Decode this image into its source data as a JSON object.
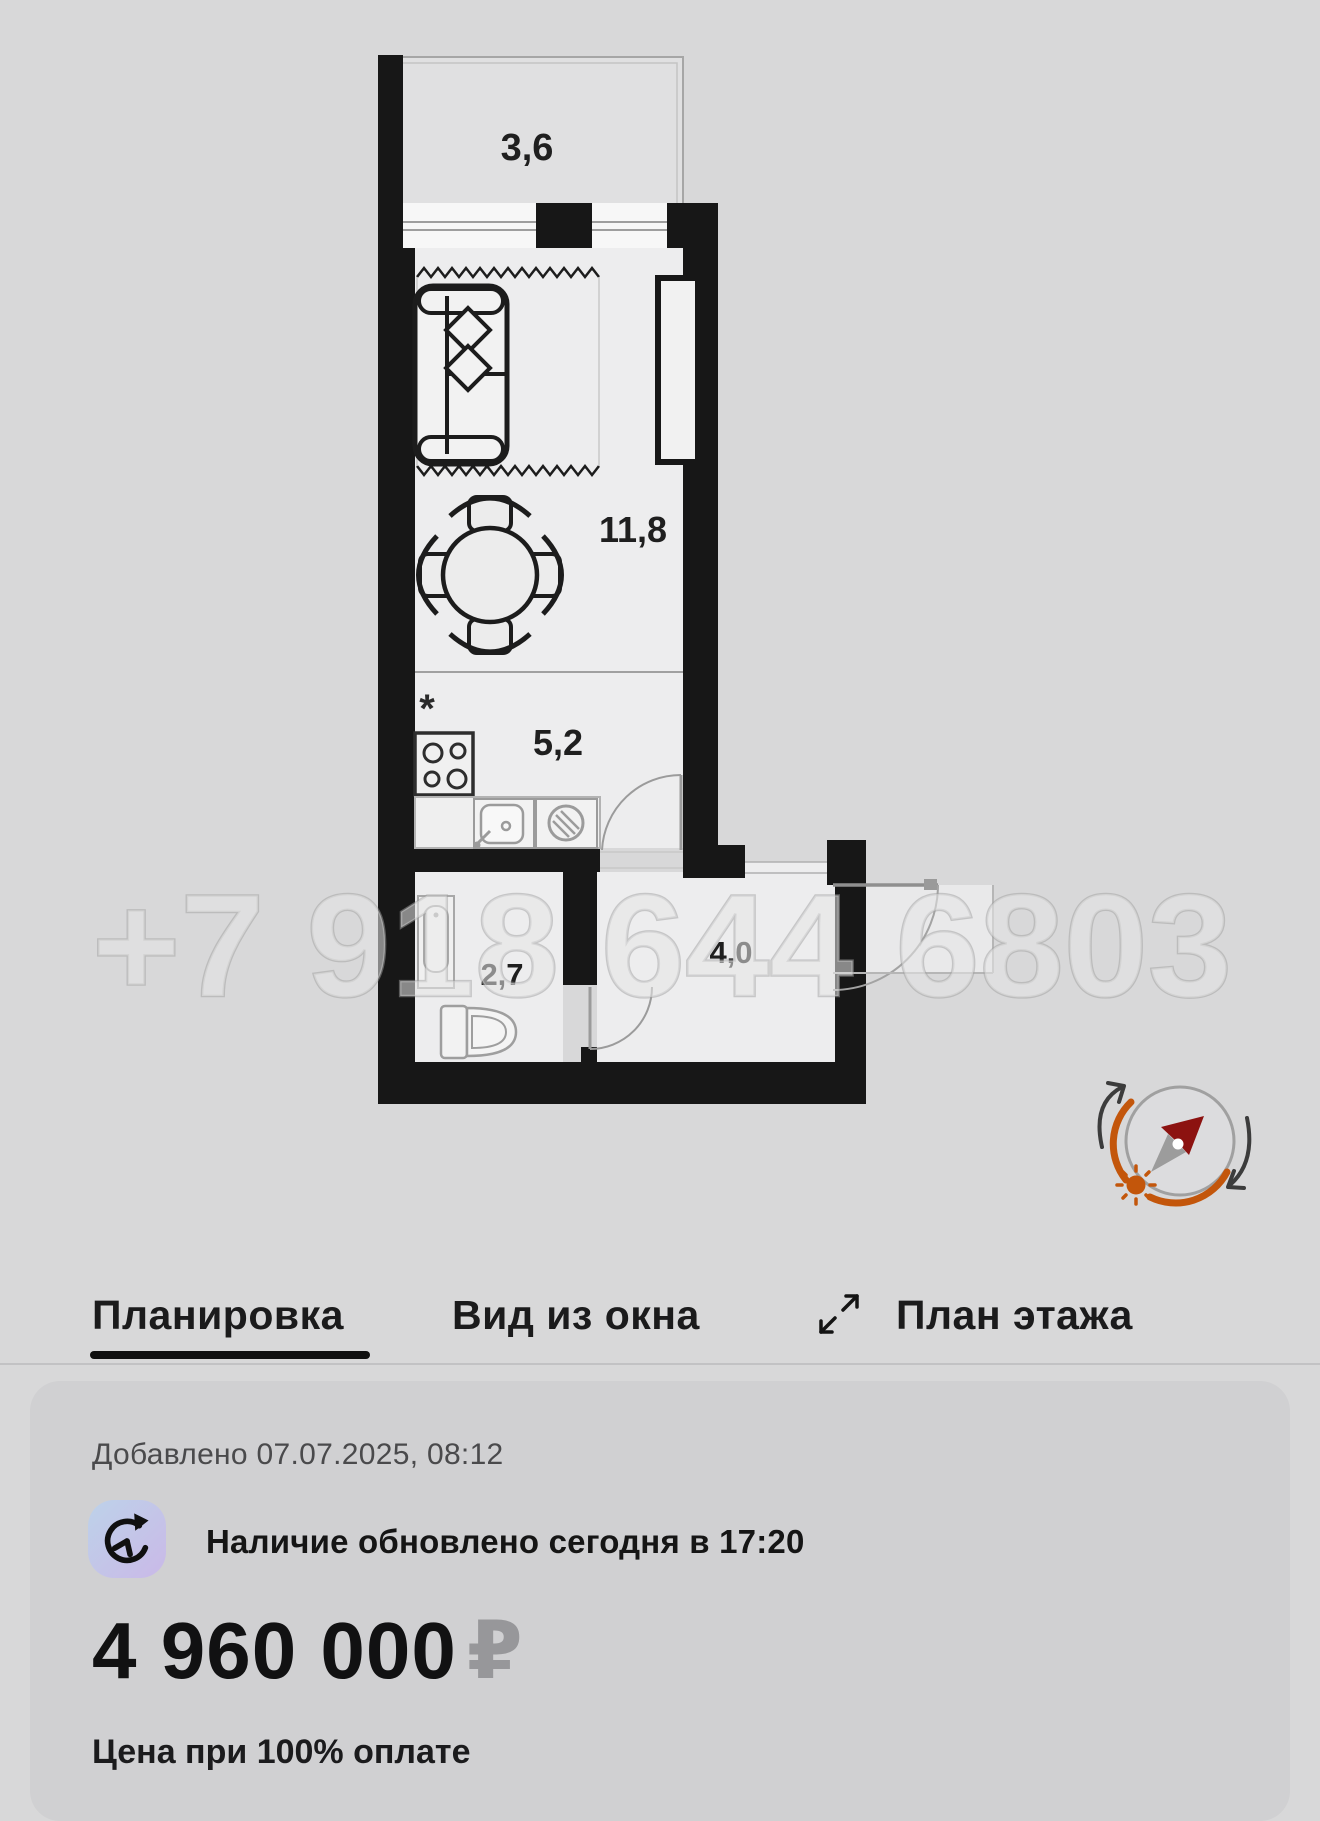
{
  "floor_plan": {
    "watermark": "+7 918 644 6803",
    "labels": {
      "balcony": "3,6",
      "living_room": "11,8",
      "kitchen": "5,2",
      "bathroom": "2,7",
      "hallway": "4,0"
    },
    "note_marker": "*",
    "icons": {
      "compass": "compass-sun-rotation-icon"
    }
  },
  "tabs": {
    "items": [
      {
        "label": "Планировка",
        "active": true
      },
      {
        "label": "Вид из окна",
        "active": false
      },
      {
        "label": "План этажа",
        "active": false
      }
    ],
    "expand_icon": "expand-arrows-icon"
  },
  "card": {
    "added": "Добавлено 07.07.2025, 08:12",
    "availability": "Наличие обновлено сегодня в 17:20",
    "availability_icon": "clock-refresh-icon",
    "price": "4 960 000",
    "currency": "₽",
    "price_note": "Цена при 100% оплате"
  },
  "colors": {
    "wall": "#171717",
    "accent_orange": "#c3560b",
    "needle_red": "#8c1210",
    "icon_gradient_start": "#bdd2e9",
    "icon_gradient_end": "#cab9e8"
  }
}
